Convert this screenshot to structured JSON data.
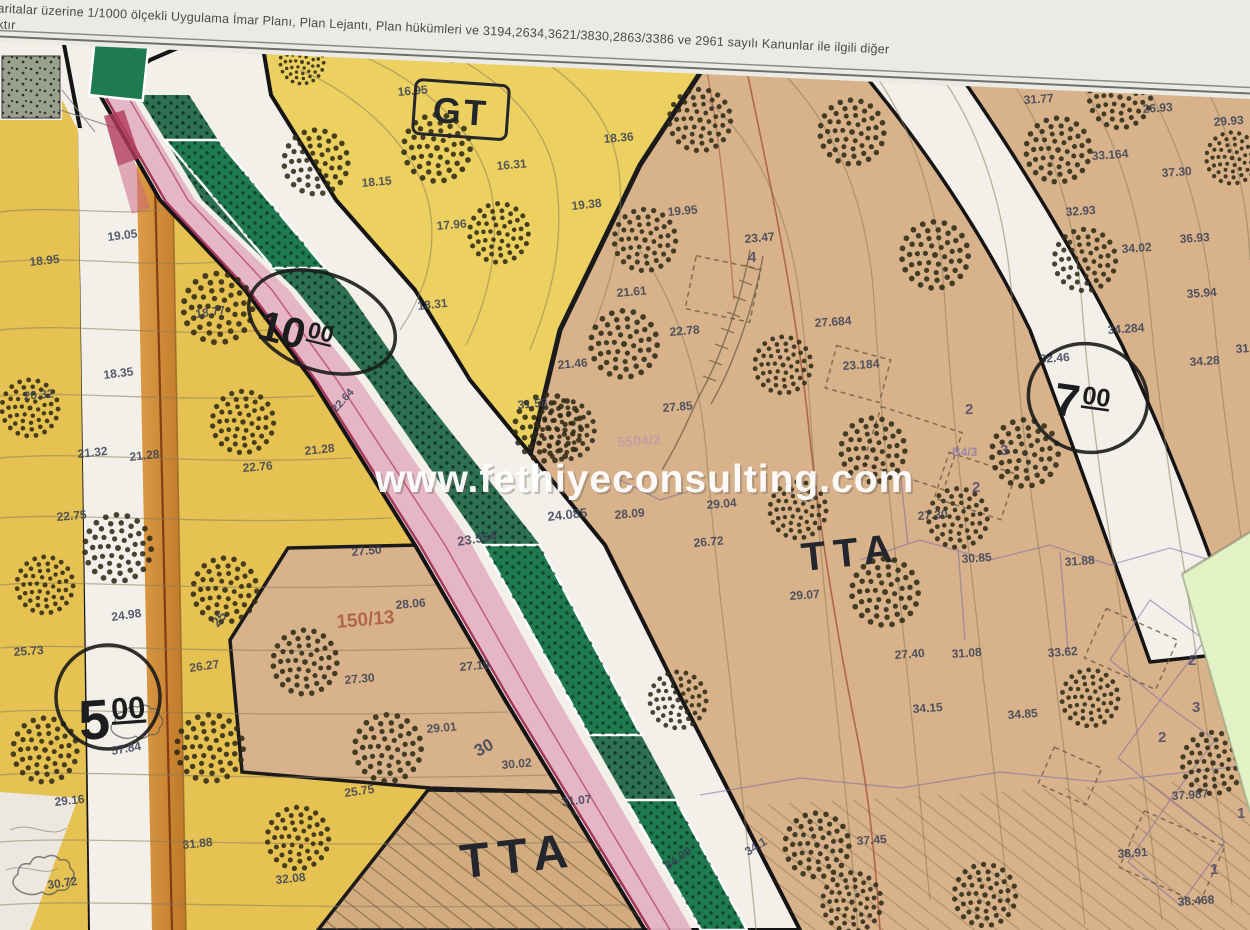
{
  "photo": {
    "header_line1": "Haritalar üzerine 1/1000 ölçekli Uygulama İmar Planı, Plan Lejantı, Plan hükümleri ve 3194,2634,3621/3830,2863/3386 ve 2961 sayılı Kanunlar ile ilgili diğer",
    "header_line2": "olacaktır",
    "watermark": "www.fethiyeconsulting.com"
  },
  "colors": {
    "paper": "#eceae4",
    "yellow": "#e5c251",
    "yellow_light": "#ecd160",
    "tan": "#d8b28a",
    "tan_dark": "#d2ab7f",
    "road_white": "#f3f0e9",
    "pink": "#e4b3c4",
    "crimson": "#a12a4c",
    "green_band": "#2e7052",
    "green_park": "#1e7a4f",
    "orange": "#cf8c3a",
    "note": "#e3f2c5",
    "stipple": "#c3c8b4",
    "stipple_dark": "#99a08e"
  },
  "map": {
    "zone_labels": [
      {
        "text": "GT",
        "x": 460,
        "y": 124,
        "size": 36,
        "rot": 4,
        "ls": 3,
        "boxed": true
      },
      {
        "text": "TTA",
        "x": 852,
        "y": 566,
        "size": 40,
        "rot": -6,
        "ls": 8,
        "boxed": false
      },
      {
        "text": "TTA",
        "x": 520,
        "y": 872,
        "size": 48,
        "rot": -6,
        "ls": 9,
        "boxed": false
      }
    ],
    "road_width_markers": [
      {
        "main": "10",
        "sup": "00",
        "cx": 322,
        "cy": 322,
        "rx": 76,
        "ry": 48,
        "erot": 20,
        "tx": 256,
        "ty": 338,
        "trot": 14,
        "msize": 42
      },
      {
        "main": "7",
        "sup": "00",
        "cx": 1088,
        "cy": 398,
        "rx": 60,
        "ry": 54,
        "erot": 15,
        "tx": 1052,
        "ty": 414,
        "trot": 8,
        "msize": 46
      },
      {
        "main": "5",
        "sup": "00",
        "cx": 108,
        "cy": 697,
        "rx": 52,
        "ry": 52,
        "erot": 0,
        "tx": 80,
        "ty": 740,
        "trot": -4,
        "msize": 56,
        "sub": "57.84",
        "sx": 112,
        "sy": 755
      }
    ],
    "parcel_refs": [
      {
        "text": "150/13",
        "x": 337,
        "y": 628,
        "color": "#a8543a",
        "size": 19,
        "rot": -5
      },
      {
        "text": "5504/2",
        "x": 618,
        "y": 447,
        "color": "#c398a6",
        "size": 14,
        "rot": -4
      },
      {
        "text": "B4/3",
        "x": 952,
        "y": 456,
        "color": "#8f7cab",
        "size": 12,
        "rot": 0
      }
    ],
    "lot_numbers": [
      [
        "2",
        965,
        414
      ],
      [
        "3",
        1000,
        455
      ],
      [
        "2",
        972,
        492
      ],
      [
        "4",
        748,
        262
      ],
      [
        "2",
        1188,
        665
      ],
      [
        "3",
        1192,
        712
      ],
      [
        "2",
        1158,
        742
      ],
      [
        "1",
        1237,
        818
      ],
      [
        "1",
        1210,
        874
      ]
    ],
    "elevation_labels": [
      [
        "19.05",
        108,
        241,
        -7
      ],
      [
        "18.95",
        30,
        266,
        -6
      ],
      [
        "18.77",
        196,
        318,
        -8
      ],
      [
        "18.35",
        104,
        379,
        -7
      ],
      [
        "20.32",
        24,
        400,
        -5
      ],
      [
        "21.32",
        78,
        458,
        -6
      ],
      [
        "21.28",
        130,
        461,
        -6
      ],
      [
        "22.75",
        57,
        521,
        -5
      ],
      [
        "24.98",
        112,
        621,
        -8
      ],
      [
        "25",
        218,
        628,
        -52,
        14
      ],
      [
        "25.73",
        14,
        656,
        -4
      ],
      [
        "26.27",
        190,
        672,
        -8
      ],
      [
        "29.16",
        55,
        806,
        -6
      ],
      [
        "31.88",
        183,
        849,
        -6
      ],
      [
        "30.72",
        48,
        889,
        -8
      ],
      [
        "32.08",
        276,
        884,
        -6
      ],
      [
        "17.41",
        449,
        63,
        -4
      ],
      [
        "16.95",
        398,
        96,
        -5
      ],
      [
        "16.31",
        497,
        170,
        -5
      ],
      [
        "18.15",
        362,
        187,
        -5
      ],
      [
        "18.36",
        604,
        143,
        -5
      ],
      [
        "19.38",
        572,
        210,
        -6
      ],
      [
        "17.96",
        437,
        230,
        -5
      ],
      [
        "18.31",
        418,
        310,
        -6
      ],
      [
        "21.28",
        305,
        455,
        -6
      ],
      [
        "22.76",
        243,
        472,
        -5
      ],
      [
        "22.64",
        336,
        413,
        -48,
        11
      ],
      [
        "23.554",
        458,
        546,
        -9,
        13
      ],
      [
        "24.085",
        548,
        521,
        -6,
        13
      ],
      [
        "19.95",
        668,
        216,
        -5
      ],
      [
        "23.47",
        745,
        243,
        -5
      ],
      [
        "21.61",
        617,
        297,
        -5
      ],
      [
        "22.78",
        670,
        336,
        -5
      ],
      [
        "21.46",
        558,
        369,
        -5
      ],
      [
        "31.58",
        518,
        409,
        -5
      ],
      [
        "27.85",
        663,
        412,
        -5
      ],
      [
        "29.04",
        707,
        509,
        -5
      ],
      [
        "28.09",
        615,
        519,
        -5
      ],
      [
        "26.72",
        694,
        547,
        -5
      ],
      [
        "29.07",
        790,
        600,
        -4
      ],
      [
        "27.30",
        918,
        520,
        -4
      ],
      [
        "27.684",
        815,
        327,
        -4
      ],
      [
        "23.184",
        843,
        370,
        -4
      ],
      [
        "27.50",
        352,
        556,
        -5
      ],
      [
        "28.06",
        396,
        609,
        -5
      ],
      [
        "27.30",
        345,
        684,
        -5
      ],
      [
        "27.19",
        460,
        671,
        -5
      ],
      [
        "29.01",
        427,
        733,
        -5
      ],
      [
        "30.02",
        502,
        769,
        -5
      ],
      [
        "30",
        478,
        757,
        -28,
        17
      ],
      [
        "25.75",
        345,
        797,
        -8
      ],
      [
        "31.77",
        1024,
        104,
        -4
      ],
      [
        "26.93",
        1143,
        113,
        -4
      ],
      [
        "29.93",
        1214,
        126,
        -4
      ],
      [
        "33.164",
        1092,
        160,
        -4
      ],
      [
        "37.30",
        1162,
        177,
        -4
      ],
      [
        "32.93",
        1066,
        216,
        -4
      ],
      [
        "34.02",
        1122,
        253,
        -4
      ],
      [
        "36.93",
        1180,
        243,
        -4
      ],
      [
        "35.94",
        1187,
        298,
        -4
      ],
      [
        "34.284",
        1108,
        334,
        -4
      ],
      [
        "32.46",
        1040,
        363,
        -4
      ],
      [
        "34.28",
        1190,
        366,
        -4
      ],
      [
        "31.58",
        1236,
        353,
        -4
      ],
      [
        "30.85",
        962,
        563,
        -4
      ],
      [
        "31.88",
        1065,
        566,
        -4
      ],
      [
        "27.40",
        895,
        659,
        -4
      ],
      [
        "31.08",
        952,
        658,
        -4
      ],
      [
        "33.62",
        1048,
        657,
        -4
      ],
      [
        "34.15",
        913,
        713,
        -4
      ],
      [
        "34.85",
        1008,
        719,
        -4
      ],
      [
        "37.987",
        1172,
        800,
        -4
      ],
      [
        "38.91",
        1118,
        858,
        -4
      ],
      [
        "38.468",
        1178,
        906,
        -4
      ],
      [
        "31.07",
        562,
        806,
        -6
      ],
      [
        "34.00",
        668,
        870,
        -35
      ],
      [
        "34.1",
        748,
        856,
        -32
      ],
      [
        "37.45",
        857,
        845,
        -4
      ]
    ],
    "trees": [
      [
        316,
        162,
        1.25
      ],
      [
        437,
        148,
        1.3
      ],
      [
        499,
        233,
        1.15
      ],
      [
        218,
        308,
        1.35
      ],
      [
        624,
        344,
        1.3
      ],
      [
        548,
        428,
        1.3
      ],
      [
        30,
        408,
        1.1
      ],
      [
        243,
        422,
        1.2
      ],
      [
        118,
        548,
        1.3
      ],
      [
        45,
        585,
        1.1
      ],
      [
        225,
        590,
        1.25
      ],
      [
        305,
        662,
        1.25
      ],
      [
        388,
        748,
        1.3
      ],
      [
        45,
        750,
        1.25
      ],
      [
        210,
        748,
        1.3
      ],
      [
        298,
        838,
        1.2
      ],
      [
        852,
        902,
        1.15
      ],
      [
        985,
        895,
        1.2
      ],
      [
        817,
        845,
        1.25
      ],
      [
        700,
        120,
        1.2
      ],
      [
        852,
        132,
        1.25
      ],
      [
        1120,
        97,
        1.2
      ],
      [
        1058,
        150,
        1.25
      ],
      [
        935,
        255,
        1.3
      ],
      [
        1085,
        260,
        1.2
      ],
      [
        645,
        240,
        1.2
      ],
      [
        565,
        430,
        1.15
      ],
      [
        783,
        365,
        1.1
      ],
      [
        798,
        510,
        1.1
      ],
      [
        885,
        592,
        1.3
      ],
      [
        873,
        450,
        1.25
      ],
      [
        1025,
        453,
        1.3
      ],
      [
        958,
        518,
        1.15
      ],
      [
        1213,
        763,
        1.2
      ],
      [
        1090,
        698,
        1.1
      ],
      [
        1232,
        158,
        1.0
      ],
      [
        678,
        700,
        1.1
      ],
      [
        302,
        62,
        0.85
      ]
    ]
  }
}
